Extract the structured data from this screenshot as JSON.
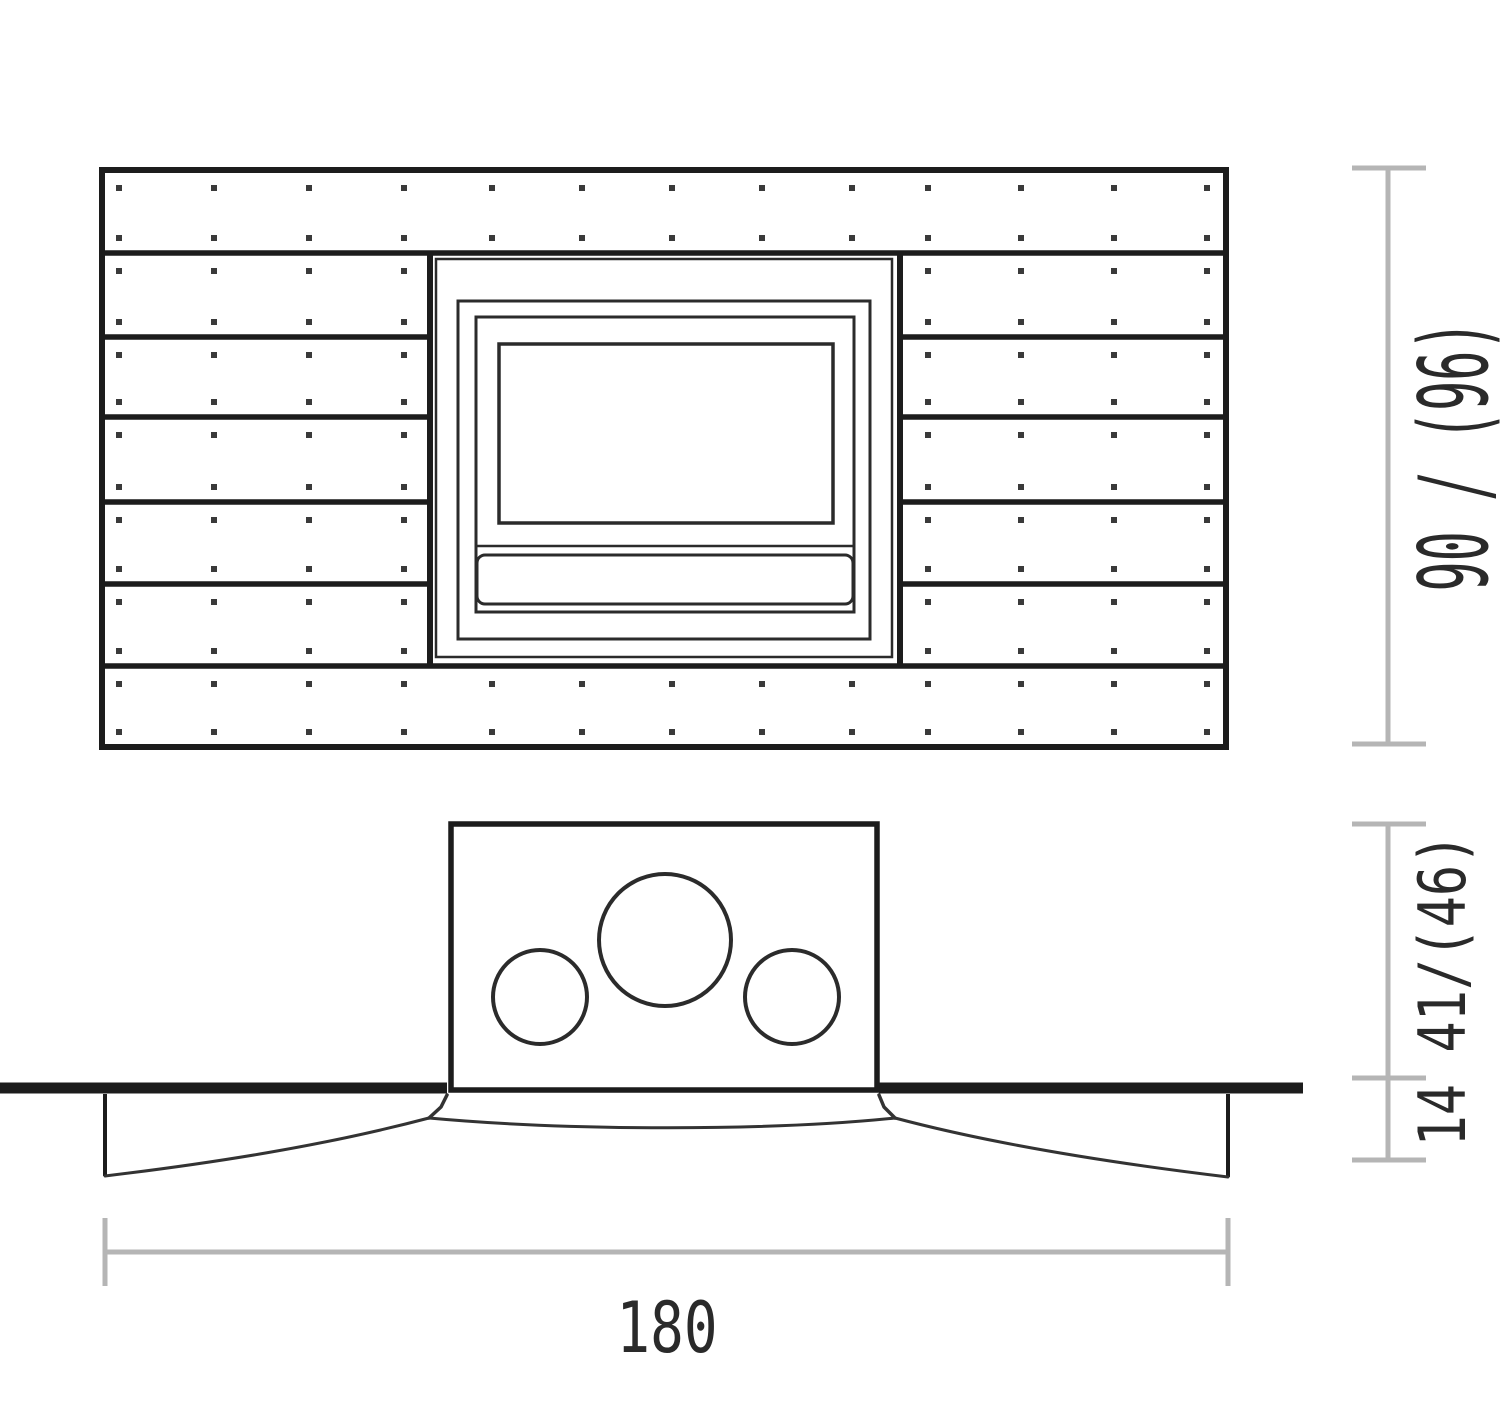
{
  "drawing": {
    "title": "Wall unit with built-in insert - dimension drawing",
    "background": "#ffffff",
    "line_color": "#1c1c1c",
    "frame_color": "#2b2b2b",
    "fastener_color": "#3a3a3a",
    "curve_color": "#333333",
    "dimension_line_color": "#b5b5b5",
    "label_color": "#2a2a2a"
  },
  "front_view": {
    "plank_rows": 7,
    "full_width_rows": 2,
    "side_plank_rows": 5,
    "fastener_rows_per_plank": 2,
    "fastener_columns_full": 13,
    "fastener_columns_side": 4,
    "insert_nested_frames": 3,
    "insert_has_window": true,
    "insert_has_bottom_vent": true
  },
  "plan_view": {
    "flue_circles": 3,
    "has_wall_line": true,
    "has_curved_front": true
  },
  "dimensions": {
    "height": {
      "label": "90 / (96)"
    },
    "depth": {
      "label": "14 41/(46)"
    },
    "width": {
      "label": "180"
    }
  }
}
